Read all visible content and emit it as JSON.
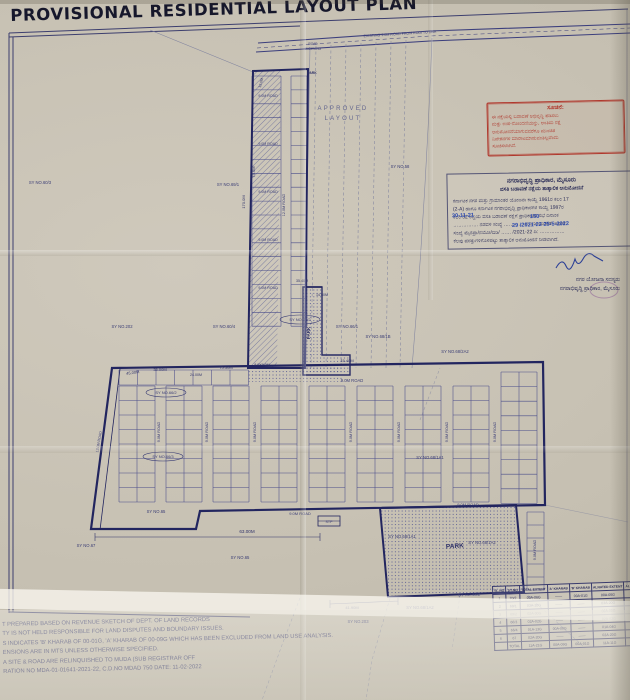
{
  "title": "PROVISIONAL RESIDENTIAL LAYOUT PLAN",
  "stamp": {
    "heading": "ಸೂಚನೆ:",
    "lines": [
      "ಈ ನಕ್ಷೆಯಲ್ಲಿ ಬಡಾವಣೆ ಅಭಿವೃದ್ಧಿ ಪಡಿಸಲು",
      "ಮತ್ತು ಉಪ-ನೋಂದಣಿಯನ್ನು, ಅಂತಿಮ ನಕ್ಷೆ",
      "ಅನುಮೋದನೆಯಾಗುವವರೆಗೂ ಮುಂಚಿತ",
      "ನಿವೇಶನಗಳ ಮಾರಾಟಮಾಡುವಂತಿಲ್ಲವೆಂದು",
      "ಸೂಚಿಸಲಾಗಿದೆ."
    ]
  },
  "approval": {
    "title1": "ನಗರಾಭಿವೃದ್ಧಿ ಪ್ರಾಧಿಕಾರ, ಮೈಸೂರು",
    "title2": "ವಸತಿ ಬಡಾವಣೆ ನಕ್ಷೆಯ ತಾತ್ಕಾಲಿಕ ಅನುಮೋದನೆ",
    "body": [
      "ಕರ್ನಾಟಕ ನಗರ ಮತ್ತು ಗ್ರಾಮಾಂತರ ಯೋಜನಾ ಕಾಯ್ದೆ 1961ರ ಕಲಂ 17",
      "(2-A) ಹಾಗೂ ಕರ್ನಾಟಕ ನಗರಾಭಿವೃದ್ಧಿ ಪ್ರಾಧಿಕಾರಗಳ ಕಾಯ್ದೆ 1987ರ",
      "ಕಲಂ 32 ರನ್ವಯ ವಸತಿ ಬಡಾವಣೆ ನಕ್ಷೆಗೆ ಪ್ರಾಧಿಕಾರದ ಸಭೆ ದಿನಾಂಕ",
      "…………… ನಡವಳಿ ಸಂಖ್ಯೆ ………… ರ ನಿರ್ಣಯದಂತೆ, ಅಧೀನ",
      "ಸಂಖ್ಯೆ ಮೈನಪ್ರಾ/ನಯೋ/ಬಿಡಿ/ …… /2021-22 ದಿ: ……………",
      "ಕೆಲವು ಷರತ್ತುಗಳಿಗೊಳಪಟ್ಟು ತಾತ್ಕಾಲಿಕ ಅನುಮೋದನೆ ನೀಡಲಾಗಿದೆ."
    ],
    "hw1": "30-11-21",
    "hw2": "150",
    "hw3": "29 /2021-22   25-5-2022",
    "sign_title": "ನಗರ ಯೋಜನಾ ಸದಸ್ಯರು",
    "sign_org": "ನಗರಾಭಿವೃದ್ಧಿ ಪ್ರಾಧಿಕಾರ, ಮೈಸೂರು"
  },
  "notes": [
    "T PREPARED BASED ON REVENUE SKETCH OF DEPT. OF LAND RECORDS",
    "TY IS NOT HELD RESPONSIBLE FOR LAND DISPUTES AND BOUNDARY ISSUES.",
    "S INDICATES 'B' KHARAB OF 00-01G, 'A' KHARAB OF 00-09G WHICH HAS BEEN EXCLUDED FROM LAND USE ANALYSIS.",
    "ENSIONS ARE IN MTS UNLESS OTHERWISE SPECIFIED.",
    "A SITE & ROAD ARE RELINQUISHED TO MUDA (SUB REGISTRAR OFF",
    "RATION NO MDA-01-01641-2021-22, C.D.NO MDAD 750 DATE: 11-02-2022"
  ],
  "table": {
    "side_label": "SY NO.68/2",
    "headers": [
      "SL.NO",
      "SY.NO",
      "TOTAL EXTENT",
      "'A' KHARAB",
      "'B' KHARAB",
      "ALNATED EXTENT",
      "ALN"
    ],
    "rows": [
      [
        "1",
        "70/2",
        "00A-06G",
        "——",
        "00A-01G",
        "00A-05G",
        ""
      ],
      [
        "2",
        "69/1",
        "03A-20G",
        "——",
        "——",
        "03A-20G",
        ""
      ],
      [
        "3",
        "69/2",
        "02A-00G",
        "——",
        "——",
        "02A-00G",
        ""
      ],
      [
        "4",
        "66/3",
        "02A-02G",
        "——",
        "——",
        "02A-02G",
        ""
      ],
      [
        "5",
        "66/4",
        "01A-13G",
        "00A-09G",
        "——",
        "01A-04G",
        ""
      ],
      [
        "6",
        "67",
        "02A-20G",
        "——",
        "——",
        "02A-20G",
        ""
      ]
    ],
    "total_row": [
      "",
      "TOTAL",
      "11A-21G",
      "00A-09G",
      "00A-01G",
      "11A-11G",
      ""
    ]
  },
  "map": {
    "labels": [
      {
        "t": "EXISTING 9.0M ROAD FROM KODI TO DBA",
        "x": 400,
        "y": 35,
        "r": -3.5,
        "s": 3.6,
        "c": "road"
      },
      {
        "t": "ROAD",
        "x": 313,
        "y": 45,
        "s": 3.2,
        "c": "road"
      },
      {
        "t": "WIDENING",
        "x": 313,
        "y": 50,
        "s": 3.2,
        "c": "road"
      },
      {
        "t": "PARK",
        "x": 312,
        "y": 74,
        "s": 3.4,
        "c": "park"
      },
      {
        "t": "APPROVED",
        "x": 343,
        "y": 110,
        "s": 6,
        "c": "appr"
      },
      {
        "t": "LAYOUT",
        "x": 343,
        "y": 120,
        "s": 6,
        "c": "appr"
      },
      {
        "t": "9.0M ROAD",
        "x": 268,
        "y": 97,
        "s": 3.6,
        "c": "road"
      },
      {
        "t": "9.0M ROAD",
        "x": 268,
        "y": 145,
        "s": 3.6,
        "c": "road"
      },
      {
        "t": "9.0M ROAD",
        "x": 268,
        "y": 193,
        "s": 3.6,
        "c": "road"
      },
      {
        "t": "9.0M ROAD",
        "x": 268,
        "y": 241,
        "s": 3.6,
        "c": "road"
      },
      {
        "t": "9.0M ROAD",
        "x": 268,
        "y": 289,
        "s": 3.6,
        "c": "road"
      },
      {
        "t": "12.0M ROAD",
        "x": 285,
        "y": 205,
        "r": -90,
        "s": 3.8,
        "c": "road"
      },
      {
        "t": "9.0M ROAD",
        "x": 352,
        "y": 382,
        "s": 4.2,
        "c": "road"
      },
      {
        "t": "9.0M ROAD",
        "x": 300,
        "y": 515,
        "s": 4,
        "c": "road"
      },
      {
        "t": "9.0M ROAD",
        "x": 468,
        "y": 506,
        "s": 4,
        "c": "road"
      },
      {
        "t": "9.0M ROAD",
        "x": 536,
        "y": 550,
        "r": -90,
        "s": 3.8,
        "c": "road"
      },
      {
        "t": "9.0M ROAD",
        "x": 160,
        "y": 432,
        "r": -90,
        "s": 3.8,
        "c": "road"
      },
      {
        "t": "9.0M ROAD",
        "x": 208,
        "y": 432,
        "r": -90,
        "s": 3.8,
        "c": "road"
      },
      {
        "t": "9.0M ROAD",
        "x": 256,
        "y": 432,
        "r": -90,
        "s": 3.8,
        "c": "road"
      },
      {
        "t": "9.0M ROAD",
        "x": 352,
        "y": 432,
        "r": -90,
        "s": 3.8,
        "c": "road"
      },
      {
        "t": "9.0M ROAD",
        "x": 400,
        "y": 432,
        "r": -90,
        "s": 3.8,
        "c": "road"
      },
      {
        "t": "9.0M ROAD",
        "x": 448,
        "y": 432,
        "r": -90,
        "s": 3.8,
        "c": "road"
      },
      {
        "t": "9.0M ROAD",
        "x": 496,
        "y": 432,
        "r": -90,
        "s": 3.8,
        "c": "road"
      },
      {
        "t": "12.0M ROAD",
        "x": 100,
        "y": 442,
        "r": -80,
        "s": 3.6,
        "c": "road"
      },
      {
        "t": "45.00M",
        "x": 133,
        "y": 374,
        "r": -8,
        "s": 4,
        "c": "dim"
      },
      {
        "t": "35.00M",
        "x": 160,
        "y": 371,
        "s": 4,
        "c": "dim"
      },
      {
        "t": "24.00M",
        "x": 196,
        "y": 376,
        "s": 3.6,
        "c": "dim"
      },
      {
        "t": "75.50M",
        "x": 226,
        "y": 369,
        "s": 4,
        "c": "dim"
      },
      {
        "t": "8.0X9.0M",
        "x": 262,
        "y": 366,
        "s": 3.6,
        "c": "dim"
      },
      {
        "t": "15.40M",
        "x": 347,
        "y": 362,
        "s": 4,
        "c": "dim"
      },
      {
        "t": "35.40M",
        "x": 302,
        "y": 282,
        "s": 3.6,
        "c": "dim"
      },
      {
        "t": "14.50M",
        "x": 322,
        "y": 296,
        "s": 3.6,
        "c": "dim"
      },
      {
        "t": "63.00M",
        "x": 247,
        "y": 533,
        "s": 4.6,
        "c": "dim"
      },
      {
        "t": "41.90M",
        "x": 352,
        "y": 609,
        "s": 4,
        "c": "dim"
      },
      {
        "t": "170.0M",
        "x": 245,
        "y": 202,
        "r": -90,
        "s": 4,
        "c": "dim"
      },
      {
        "t": "75.0M",
        "x": 255,
        "y": 172,
        "r": -90,
        "s": 4,
        "c": "dim"
      },
      {
        "t": "15.0M",
        "x": 262,
        "y": 83,
        "r": -75,
        "s": 3.6,
        "c": "dim"
      },
      {
        "t": "SY NO.60/3",
        "x": 40,
        "y": 184,
        "s": 4.2,
        "c": "svy"
      },
      {
        "t": "SY NO.202",
        "x": 122,
        "y": 328,
        "s": 4.2,
        "c": "svy"
      },
      {
        "t": "SY NO.60/4",
        "x": 224,
        "y": 328,
        "s": 4.2,
        "c": "svy"
      },
      {
        "t": "SY NO.69/1",
        "x": 228,
        "y": 186,
        "s": 4.2,
        "c": "svy"
      },
      {
        "t": "SY NO.58",
        "x": 400,
        "y": 168,
        "s": 4.2,
        "c": "svy"
      },
      {
        "t": "SY NO.66/1",
        "x": 347,
        "y": 328,
        "s": 4.2,
        "c": "svy"
      },
      {
        "t": "SY NO.68/1B",
        "x": 378,
        "y": 338,
        "s": 4.2,
        "c": "svy"
      },
      {
        "t": "SY NO.68/2A2",
        "x": 455,
        "y": 353,
        "s": 4.2,
        "c": "svy"
      },
      {
        "t": "SY NO.68/1A1",
        "x": 430,
        "y": 459,
        "s": 4.2,
        "c": "svy"
      },
      {
        "t": "SY NO.68/1A1",
        "x": 402,
        "y": 538,
        "s": 4.2,
        "c": "svy"
      },
      {
        "t": "SY NO.68/1A2",
        "x": 482,
        "y": 544,
        "s": 4.2,
        "c": "svy"
      },
      {
        "t": "SY NO.67",
        "x": 86,
        "y": 547,
        "s": 4.2,
        "c": "svy"
      },
      {
        "t": "SY NO.65",
        "x": 156,
        "y": 513,
        "s": 4.2,
        "c": "svy"
      },
      {
        "t": "SY NO.65",
        "x": 240,
        "y": 559,
        "s": 4.2,
        "c": "svy"
      },
      {
        "t": "SY NO.203",
        "x": 358,
        "y": 623,
        "s": 4.2,
        "c": "svy"
      },
      {
        "t": "SY NO.68/1A2",
        "x": 420,
        "y": 609,
        "s": 4.2,
        "c": "svy"
      },
      {
        "t": "SY NO.66/2",
        "x": 166,
        "y": 394,
        "s": 4,
        "c": "svy",
        "o": true
      },
      {
        "t": "SY NO.66/3",
        "x": 163,
        "y": 458,
        "s": 4,
        "c": "svy",
        "o": true
      },
      {
        "t": "SY NO.66/2",
        "x": 300,
        "y": 321,
        "s": 4,
        "c": "svy",
        "o": true
      },
      {
        "t": "PARK",
        "x": 310,
        "y": 333,
        "r": -90,
        "s": 4.5,
        "c": "park"
      },
      {
        "t": "PARK",
        "x": 455,
        "y": 548,
        "r": -4,
        "s": 6.5,
        "c": "park"
      },
      {
        "t": "STP",
        "x": 329,
        "y": 523,
        "s": 3.6,
        "c": "road"
      }
    ]
  }
}
